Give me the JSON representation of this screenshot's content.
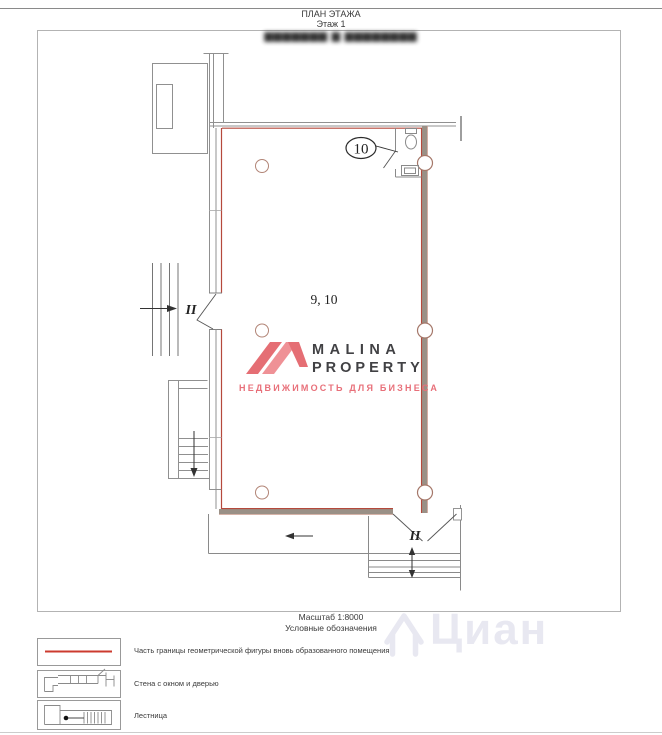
{
  "page": {
    "title": "ПЛАН ЭТАЖА",
    "subtitle": "Этаж 1",
    "censored_address": "▆▆▆▆▆▆▆ ▆ ▆▆▆▆▆▆▆▆",
    "scale_caption": "Масштаб 1:8000",
    "legend_caption": "Условные обозначения"
  },
  "plan": {
    "room_label": "9, 10",
    "bathroom_callout": "10",
    "left_door_label": "II",
    "bottom_door_label": "II"
  },
  "legend": {
    "items": [
      {
        "symbol": "red-boundary-line",
        "label": "Часть границы геометрической фигуры вновь образованного помещения"
      },
      {
        "symbol": "wall-with-window-and-door",
        "label": "Стена с окном и дверью"
      },
      {
        "symbol": "stairs",
        "label": "Лестница"
      }
    ]
  },
  "logo": {
    "name": "MALINA",
    "name2": "PROPERTY",
    "tagline": "НЕДВИЖИМОСТЬ ДЛЯ БИЗНЕСА",
    "brand_color": "#e8707a",
    "text_color": "#414144"
  },
  "watermark": {
    "text": "Циан",
    "color": "#e8e8f1"
  },
  "colors": {
    "boundary_red": "#b5493c",
    "legend_red": "#cc3b2f",
    "wall_gray": "#909090",
    "wall_brown": "#9a9086",
    "column_stroke": "#ab8070"
  }
}
